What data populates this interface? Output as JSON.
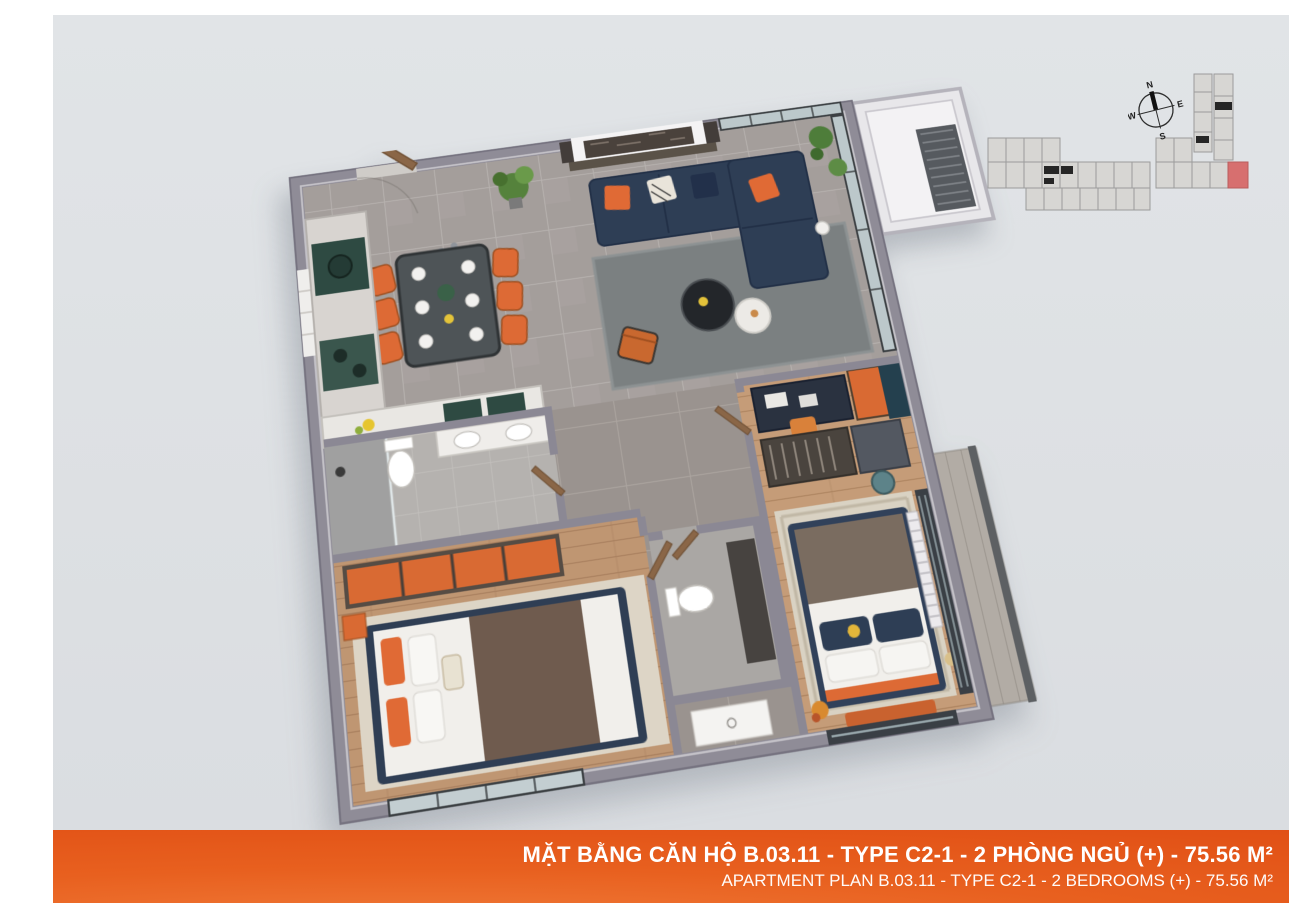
{
  "banner": {
    "line1": "MẶT BẰNG CĂN HỘ B.03.11 - TYPE C2-1 - 2 PHÒNG NGỦ (+) - 75.56 M²",
    "line2": "APARTMENT PLAN B.03.11 - TYPE C2-1 - 2 BEDROOMS (+) - 75.56 M²",
    "accent_color": "#e4551b",
    "text_color": "#ffffff"
  },
  "unit": {
    "unit_code": "B.03.11",
    "type_code": "C2-1",
    "bedrooms": "2",
    "area": "75.56 M²"
  },
  "compass": {
    "north": "N",
    "east": "E",
    "south": "S",
    "west": "W"
  },
  "key_plan": {
    "highlighted_unit": "B.03.11",
    "highlight_color": "#d76f6f",
    "cell_color": "#d7d6d3",
    "outline_color": "#9b9b9b"
  },
  "palette": {
    "panel_bg": "#dee1e4",
    "wall_gray": "#8f8c97",
    "marble_floor": "#a49e9b",
    "hall_floor": "#9a938f",
    "wood_floor": "#bf9672",
    "sofa_navy": "#2e3e55",
    "accent_orange": "#e0662f",
    "rug_gray": "#7b8081",
    "rug_cream": "#d9d2c3",
    "door_wood": "#8a6647"
  },
  "floor_plan_rooms": [
    "entry",
    "dining",
    "kitchen",
    "living-room",
    "study-nook",
    "bathroom-1",
    "bedroom-2",
    "wc-2",
    "hallway",
    "master-bedroom",
    "balcony",
    "ac-ledge"
  ]
}
